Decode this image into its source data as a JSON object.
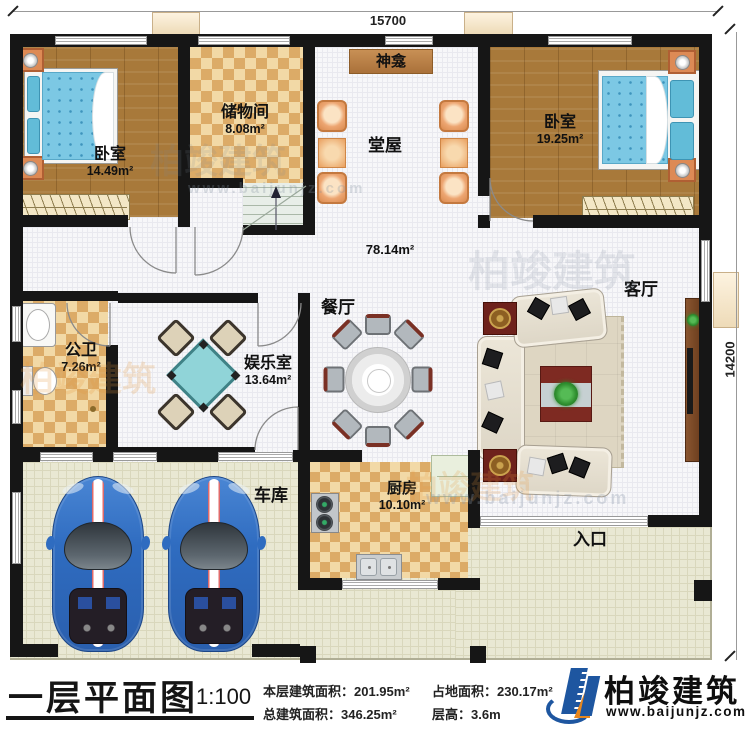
{
  "dimensions": {
    "top": "15700",
    "right": "14200"
  },
  "rooms": {
    "bedroom_left": {
      "name": "卧室",
      "area": "14.49m²"
    },
    "storage": {
      "name": "储物间",
      "area": "8.08m²"
    },
    "shrine": {
      "name": "神龛"
    },
    "hall": {
      "name": "堂屋"
    },
    "bedroom_right": {
      "name": "卧室",
      "area": "19.25m²"
    },
    "open_area": {
      "area": "78.14m²"
    },
    "dining": {
      "name": "餐厅"
    },
    "living": {
      "name": "客厅"
    },
    "bathroom": {
      "name": "公卫",
      "area": "7.26m²"
    },
    "entertainment": {
      "name": "娱乐室",
      "area": "13.64m²"
    },
    "garage": {
      "name": "车库"
    },
    "kitchen": {
      "name": "厨房",
      "area": "10.10m²"
    },
    "entrance": {
      "name": "入口"
    }
  },
  "footer": {
    "title": "一层平面图",
    "scale": "1:100",
    "stats": [
      {
        "text": "本层建筑面积：201.95m²"
      },
      {
        "text": "占地面积：230.17m²"
      },
      {
        "text": "总建筑面积：346.25m²"
      },
      {
        "text": "层高：3.6m"
      }
    ],
    "brand": {
      "name": "柏竣建筑",
      "site": "www.baijunjz.com"
    }
  },
  "watermarks": {
    "brand": "柏竣建筑",
    "site": "www.baijunjz.com"
  },
  "colors": {
    "wall": "#161616",
    "wood": "#a8793a",
    "checker_dark": "#dcab67",
    "checker_light": "#f2d9a6",
    "porch": "#e9e8d3",
    "accent_blue": "#1e56a0",
    "accent_orange": "#e8871e",
    "car": "#2e6bbf",
    "mahjong": "#8ed2d6"
  }
}
